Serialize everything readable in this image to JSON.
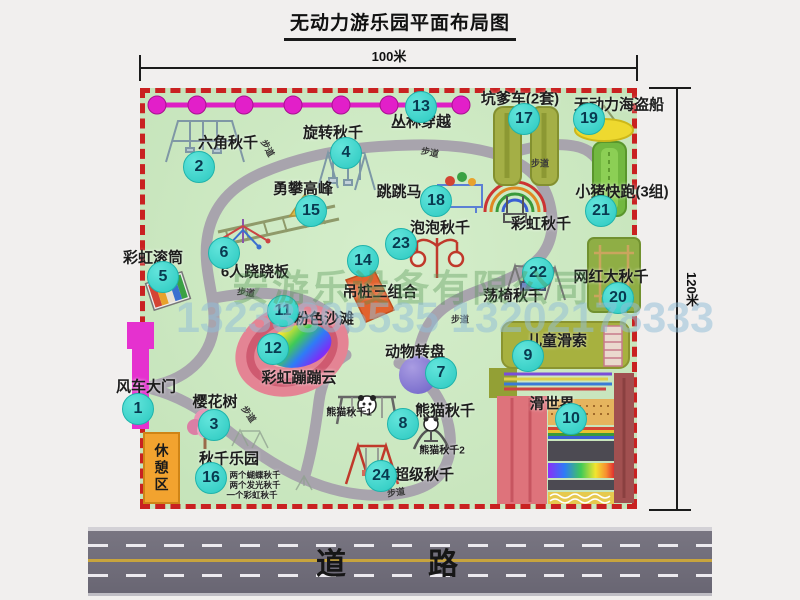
{
  "title": "无动力游乐园平面布局图",
  "dimensions": {
    "width_label": "100米",
    "height_label": "120米"
  },
  "road": {
    "label": "道　路"
  },
  "watermark": {
    "company": "安游乐设备有限公司",
    "phones": "13233805535 13202178333"
  },
  "path_label": "步道",
  "rest_area_label": "休憩区",
  "attractions": {
    "a1": {
      "num": "1",
      "label": "风车大门"
    },
    "a2": {
      "num": "2",
      "label": "六角秋千"
    },
    "a3": {
      "num": "3",
      "label": "樱花树"
    },
    "a4": {
      "num": "4",
      "label": "旋转秋千"
    },
    "a5": {
      "num": "5",
      "label": "彩虹滚筒"
    },
    "a6": {
      "num": "6",
      "label": "6人跷跷板"
    },
    "a7": {
      "num": "7",
      "label": "动物转盘"
    },
    "a8": {
      "num": "8",
      "label": "熊猫秋千"
    },
    "a9": {
      "num": "9",
      "label": "儿童滑索"
    },
    "a10": {
      "num": "10",
      "label": "滑世界"
    },
    "a11": {
      "num": "11",
      "label": "粉色沙滩"
    },
    "a12": {
      "num": "12",
      "label": "彩虹蹦蹦云"
    },
    "a13": {
      "num": "13",
      "label": "丛林穿越"
    },
    "a14": {
      "num": "14",
      "label": "吊桩三组合"
    },
    "a15": {
      "num": "15",
      "label": "勇攀高峰"
    },
    "a16": {
      "num": "16",
      "label": "秋千乐园",
      "notes": [
        "两个蝴蝶秋千",
        "两个发光秋千",
        "一个彩虹秋千"
      ]
    },
    "a17": {
      "num": "17",
      "label": "坑爹车(2套)"
    },
    "a18": {
      "num": "18",
      "label": "跳跳马"
    },
    "a19": {
      "num": "19",
      "label": "无动力海盗船"
    },
    "a20": {
      "num": "20",
      "label": "网红大秋千"
    },
    "a21": {
      "num": "21",
      "label": "小猪快跑(3组)"
    },
    "a22": {
      "num": "22",
      "label": "荡椅秋千"
    },
    "a23": {
      "num": "23",
      "label": "泡泡秋千"
    },
    "a24": {
      "num": "24",
      "label": "超级秋千"
    }
  },
  "extra_labels": {
    "rainbow_swing": "彩虹秋千",
    "panda_swing_1": "熊猫秋千1",
    "panda_swing_2": "熊猫秋千2"
  },
  "colors": {
    "park_green": "#c8e5bd",
    "boundary_red": "#c92121",
    "badge_cyan": "#3ed3c9",
    "gate_magenta": "#e531cf",
    "rest_orange": "#f2a32f",
    "road_gray": "#6e6b77"
  }
}
